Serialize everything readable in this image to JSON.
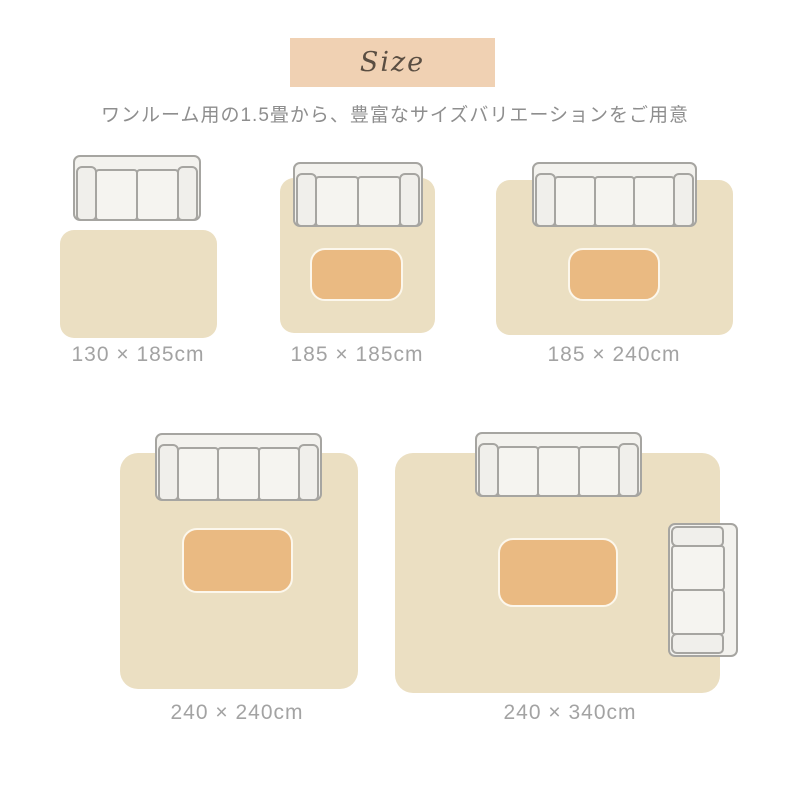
{
  "header": {
    "size_label": "Size",
    "subtitle": "ワンルーム用の1.5畳から、豊富なサイズバリエーションをご用意"
  },
  "diagrams": [
    {
      "label": "130 × 185cm",
      "sofa_seats": 2,
      "has_table": false
    },
    {
      "label": "185 × 185cm",
      "sofa_seats": 2,
      "has_table": true
    },
    {
      "label": "185 × 240cm",
      "sofa_seats": 3,
      "has_table": true
    },
    {
      "label": "240 × 240cm",
      "sofa_seats": 3,
      "has_table": true
    },
    {
      "label": "240 × 340cm",
      "sofa_seats": 3,
      "side_sofa_seats": 2,
      "has_table": true
    }
  ],
  "colors": {
    "page_bg": "#ffffff",
    "size_box_bg": "#f0d1b3",
    "size_text": "#5a4e42",
    "subtitle_text": "#8e8e8e",
    "label_text": "#a3a3a3",
    "rug_fill": "#ebdfc2",
    "table_fill": "#eaba82",
    "table_border": "#fcf7ec",
    "sofa_fill": "#f3f2ee",
    "sofa_border": "#a6a5a1"
  }
}
